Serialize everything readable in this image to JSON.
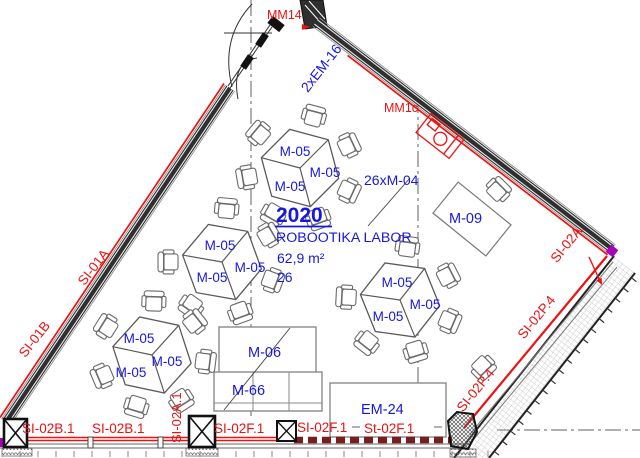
{
  "plan": {
    "room": {
      "number": "2020",
      "name": "ROBOOTIKA LABOR",
      "area": "62,9 m²",
      "capacity": "26"
    },
    "furniture": {
      "chair_group_count": "26xM-04",
      "chair_label": "M-05",
      "side_table": "M-09",
      "cabinet_1": "M-06",
      "cabinet_2": "M-66",
      "bench": "EM-24",
      "door_label": "2xEM-16"
    },
    "markers": {
      "mm14": "MM14",
      "mm1c": "MM1c"
    },
    "walls": {
      "left_upper": "SI-01A",
      "left_lower": "SI-01B",
      "bottom_b1": "SI-02B.1",
      "bottom_b2": "SI-02B.1",
      "bottom_f1": "SI-02F.1",
      "bottom_f2": "SI-02F.1",
      "bottom_f3": "St-02F.1",
      "pier_vertical": "SI-02A.1",
      "right_a": "SI-02A.",
      "right_p1": "SI-02P.4",
      "right_p2": "SI-02P.4"
    },
    "colors": {
      "label_blue": "#1717e0",
      "label_red": "#ee1111",
      "firewall": "#7a1d1d",
      "wall_dark": "#2f2f2f",
      "magenta": "#aa00bb"
    }
  }
}
